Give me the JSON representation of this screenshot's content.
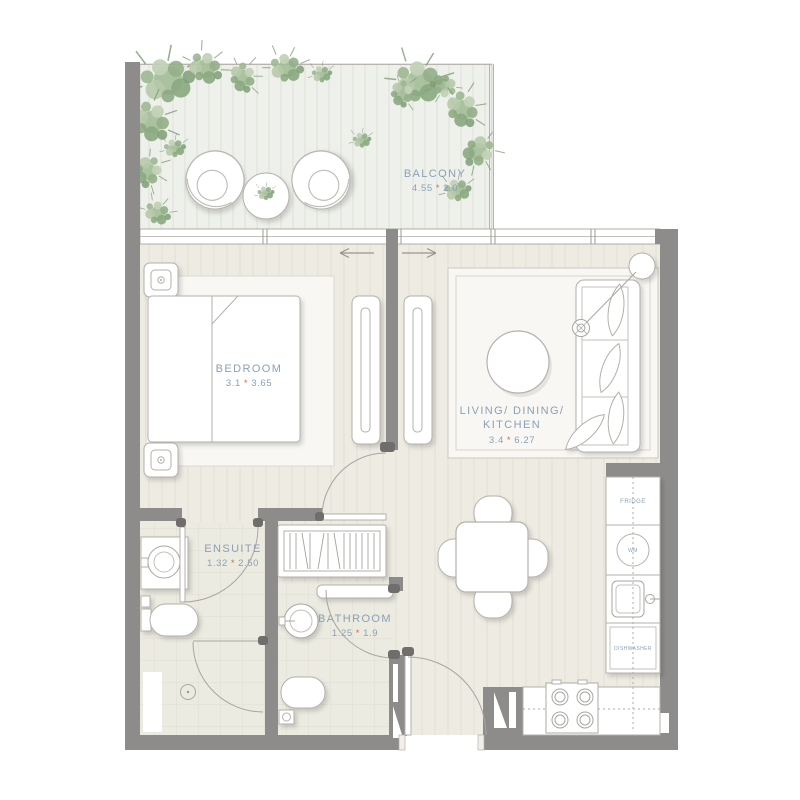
{
  "plan_title": "one-bedroom apartment floor plan",
  "dim_separator": "*",
  "rooms": {
    "balcony": {
      "name": "BALCONY",
      "w": "4.55",
      "h": "2.0"
    },
    "bedroom": {
      "name": "BEDROOM",
      "w": "3.1",
      "h": "3.65"
    },
    "living": {
      "name_line1": "LIVING/ DINING/",
      "name_line2": "KITCHEN",
      "w": "3.4",
      "h": "6.27"
    },
    "ensuite": {
      "name": "ENSUITE",
      "w": "1.32",
      "h": "2.50"
    },
    "bathroom": {
      "name": "BATHROOM",
      "w": "1.25",
      "h": "1.9"
    }
  },
  "appliances": {
    "fridge": "FRIDGE",
    "washing_machine": "WM",
    "dishwasher": "DISHWASHER"
  },
  "colors": {
    "wall": "#8d8c8a",
    "floor": "#edebe2",
    "deck": "#eef0eb",
    "outline": "#b3b1a9",
    "label": "#8aa1b6",
    "dim_star": "#c4734c",
    "rug": "#f8f7f3",
    "plant": "#a3bd98"
  }
}
